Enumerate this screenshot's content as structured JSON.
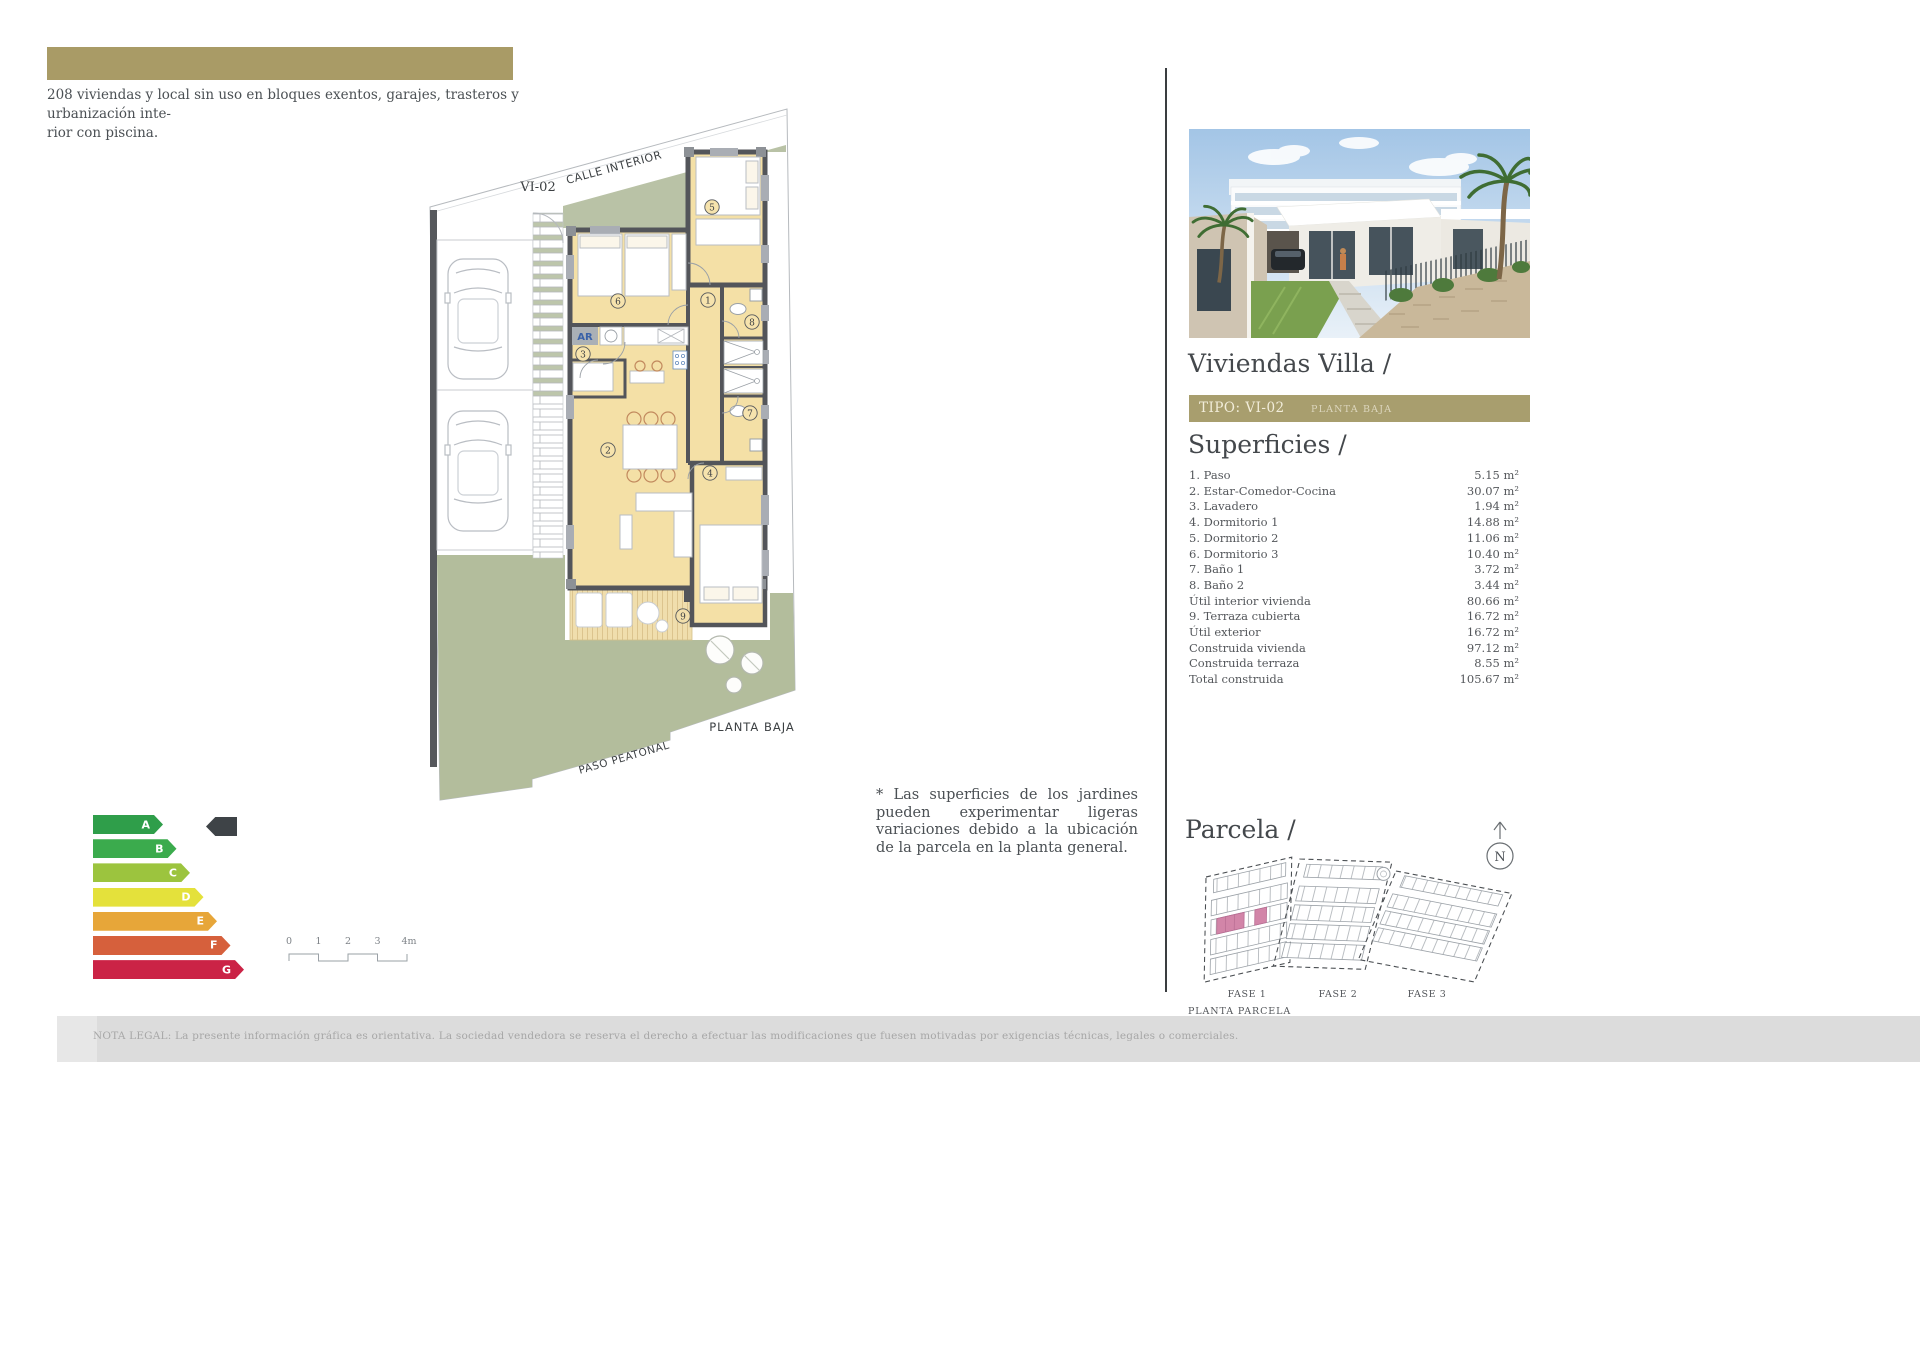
{
  "page": {
    "intro_lines": [
      "208 viviendas y local sin uso en bloques exentos, garajes, trasteros y urbanización inte-",
      "rior con piscina."
    ],
    "note": "* Las superficies de los jardines pueden experimentar ligeras variaciones debido a la ubicación de la parcela en la planta general.",
    "legal": "NOTA LEGAL: La presente información gráfica es orientativa. La sociedad vendedora se reserva el derecho a efectuar las modificaciones que fuesen motivadas por exigencias técnicas, legales o comerciales."
  },
  "plan": {
    "street_label": "CALLE INTERIOR",
    "unit_label": "VI-02",
    "floor_label": "PLANTA BAJA",
    "path_label": "PASO PEATONAL",
    "laundry_tag": "AR",
    "room_numbers": [
      "1",
      "2",
      "3",
      "4",
      "5",
      "6",
      "7",
      "8",
      "9"
    ]
  },
  "energy_label": {
    "ratings": [
      {
        "letter": "A",
        "color": "#2f9e4a"
      },
      {
        "letter": "B",
        "color": "#3bab4d"
      },
      {
        "letter": "C",
        "color": "#9cc43e"
      },
      {
        "letter": "D",
        "color": "#e4e13b"
      },
      {
        "letter": "E",
        "color": "#e7a639"
      },
      {
        "letter": "F",
        "color": "#d6603c"
      },
      {
        "letter": "G",
        "color": "#cb2346"
      }
    ],
    "indicator_color": "#3e4347"
  },
  "scale_bar": {
    "ticks": [
      "0",
      "1",
      "2",
      "3",
      "4m"
    ]
  },
  "sidebar": {
    "title": "Viviendas Villa /",
    "type_bar": {
      "type_label": "TIPO: VI-02",
      "floor_label": "PLANTA BAJA",
      "color": "#a89e6e"
    },
    "surfaces": {
      "heading": "Superficies /",
      "rows": [
        {
          "label": "1. Paso",
          "value": "5.15 m²"
        },
        {
          "label": "2. Estar-Comedor-Cocina",
          "value": "30.07 m²"
        },
        {
          "label": "3. Lavadero",
          "value": "1.94 m²"
        },
        {
          "label": "4. Dormitorio 1",
          "value": "14.88 m²"
        },
        {
          "label": "5. Dormitorio 2",
          "value": "11.06 m²"
        },
        {
          "label": "6. Dormitorio 3",
          "value": "10.40 m²"
        },
        {
          "label": "7. Baño 1",
          "value": "3.72 m²"
        },
        {
          "label": "8. Baño 2",
          "value": "3.44 m²"
        },
        {
          "label": "Útil interior vivienda",
          "value": "80.66 m²"
        },
        {
          "label": "9. Terraza cubierta",
          "value": "16.72 m²"
        },
        {
          "label": "Útil exterior",
          "value": "16.72 m²"
        },
        {
          "label": "Construida vivienda",
          "value": "97.12 m²"
        },
        {
          "label": "Construida terraza",
          "value": "8.55 m²"
        },
        {
          "label": "Total construida",
          "value": "105.67 m²"
        }
      ]
    },
    "parcela": {
      "heading": "Parcela /",
      "compass_label": "N",
      "phase_labels": [
        "FASE 1",
        "FASE 2",
        "FASE 3"
      ],
      "caption": "PLANTA PARCELA",
      "highlight_color": "#d285a8"
    }
  },
  "colors": {
    "gold_bar": "#a99b66",
    "plan_room_fill": "#f4e0a6",
    "plan_green": "#b9c2a6",
    "plan_wall": "#53555a"
  }
}
